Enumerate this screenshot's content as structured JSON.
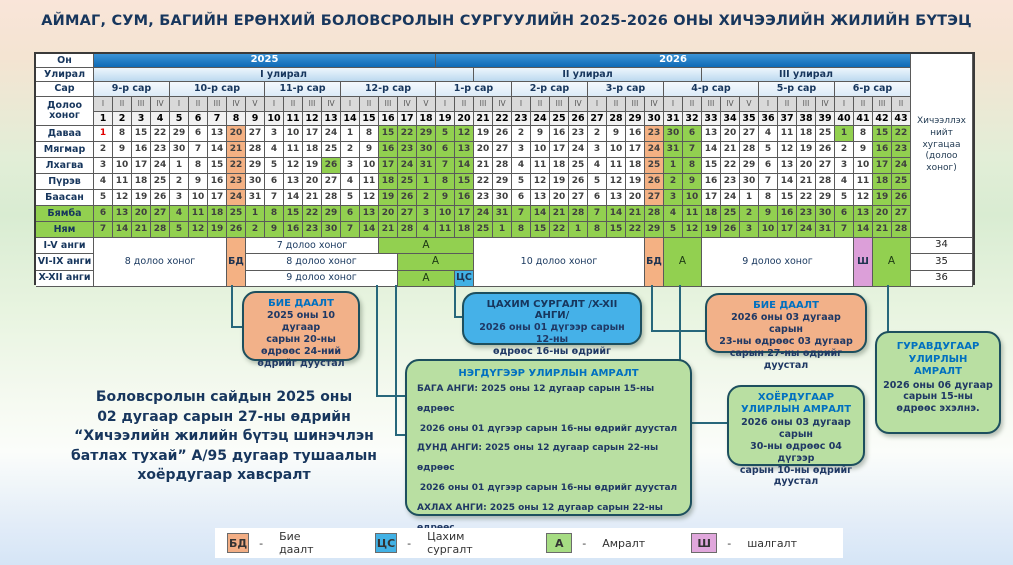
{
  "title": "АЙМАГ, СУМ, БАГИЙН ЕРӨНХИЙ БОЛОВСРОЛЫН СУРГУУЛИЙН 2025-2026 ОНЫ ХИЧЭЭЛИЙН ЖИЛИЙН БҮТЭЦ",
  "note_lines": [
    "Боловсролын сайдын 2025 оны",
    "02 дугаар сарын 27-ны өдрийн",
    "“Хичээлийн жилийн бүтэц шинэчлэн",
    "батлах тухай” А/95 дугаар тушаалын",
    "хоёрдугаар хавсралт"
  ],
  "table": {
    "corner_labels": {
      "year": "Он",
      "quarter": "Улирал",
      "month": "Сар",
      "week": "Долоо хоног"
    },
    "right_header": "Хичээллэх нийт хугацаа (долоо хоног)",
    "years": [
      {
        "label": "2025",
        "span": 18
      },
      {
        "label": "2026",
        "span": 25
      }
    ],
    "quarters": [
      {
        "label": "I улирал",
        "span": 20
      },
      {
        "label": "II улирал",
        "span": 12
      },
      {
        "label": "III улирал",
        "span": 11
      }
    ],
    "months": [
      {
        "label": "9-р сар",
        "span": 4
      },
      {
        "label": "10-р сар",
        "span": 5
      },
      {
        "label": "11-р сар",
        "span": 4
      },
      {
        "label": "12-р сар",
        "span": 5
      },
      {
        "label": "1-р сар",
        "span": 4
      },
      {
        "label": "2-р сар",
        "span": 4
      },
      {
        "label": "3-р сар",
        "span": 4
      },
      {
        "label": "4-р сар",
        "span": 5
      },
      {
        "label": "5-р сар",
        "span": 4
      },
      {
        "label": "6-р сар",
        "span": 4
      }
    ],
    "week_romans": [
      "I",
      "II",
      "III",
      "IV",
      "I",
      "II",
      "III",
      "IV",
      "V",
      "I",
      "II",
      "III",
      "IV",
      "I",
      "II",
      "III",
      "IV",
      "V",
      "I",
      "II",
      "III",
      "IV",
      "I",
      "II",
      "III",
      "IV",
      "I",
      "II",
      "III",
      "IV",
      "I",
      "II",
      "III",
      "IV",
      "V",
      "I",
      "II",
      "III",
      "IV",
      "I",
      "II",
      "III",
      "II"
    ],
    "week_numbers": [
      1,
      2,
      3,
      4,
      5,
      6,
      7,
      8,
      9,
      10,
      11,
      12,
      13,
      14,
      15,
      16,
      17,
      18,
      19,
      20,
      21,
      22,
      23,
      24,
      25,
      26,
      27,
      28,
      29,
      30,
      31,
      32,
      33,
      34,
      35,
      36,
      37,
      38,
      39,
      40,
      41,
      42,
      43
    ],
    "day_rows": [
      {
        "label": "Даваа",
        "weekend": false,
        "dates": [
          1,
          8,
          15,
          22,
          29,
          6,
          13,
          20,
          27,
          3,
          10,
          17,
          24,
          1,
          8,
          15,
          22,
          29,
          5,
          12,
          19,
          26,
          2,
          9,
          16,
          23,
          2,
          9,
          16,
          23,
          30,
          6,
          13,
          20,
          27,
          4,
          11,
          18,
          25,
          1,
          8,
          15,
          22
        ]
      },
      {
        "label": "Мягмар",
        "weekend": false,
        "dates": [
          2,
          9,
          16,
          23,
          30,
          7,
          14,
          21,
          28,
          4,
          11,
          18,
          25,
          2,
          9,
          16,
          23,
          30,
          6,
          13,
          20,
          27,
          3,
          10,
          17,
          24,
          3,
          10,
          17,
          24,
          31,
          7,
          14,
          21,
          28,
          5,
          12,
          19,
          26,
          2,
          9,
          16,
          23
        ]
      },
      {
        "label": "Лхагва",
        "weekend": false,
        "dates": [
          3,
          10,
          17,
          24,
          1,
          8,
          15,
          22,
          29,
          5,
          12,
          19,
          26,
          3,
          10,
          17,
          24,
          31,
          7,
          14,
          21,
          28,
          4,
          11,
          18,
          25,
          4,
          11,
          18,
          25,
          1,
          8,
          15,
          22,
          29,
          6,
          13,
          20,
          27,
          3,
          10,
          17,
          24
        ]
      },
      {
        "label": "Пүрэв",
        "weekend": false,
        "dates": [
          4,
          11,
          18,
          25,
          2,
          9,
          16,
          23,
          30,
          6,
          13,
          20,
          27,
          4,
          11,
          18,
          25,
          1,
          8,
          15,
          22,
          29,
          5,
          12,
          19,
          26,
          5,
          12,
          19,
          26,
          2,
          9,
          16,
          23,
          30,
          7,
          14,
          21,
          28,
          4,
          11,
          18,
          25
        ]
      },
      {
        "label": "Баасан",
        "weekend": false,
        "dates": [
          5,
          12,
          19,
          26,
          3,
          10,
          17,
          24,
          31,
          7,
          14,
          21,
          28,
          5,
          12,
          19,
          26,
          2,
          9,
          16,
          23,
          30,
          6,
          13,
          20,
          27,
          6,
          13,
          20,
          27,
          3,
          10,
          17,
          24,
          1,
          8,
          15,
          22,
          29,
          5,
          12,
          19,
          26
        ]
      },
      {
        "label": "Бямба",
        "weekend": true,
        "dates": [
          6,
          13,
          20,
          27,
          4,
          11,
          18,
          25,
          1,
          8,
          15,
          22,
          29,
          6,
          13,
          20,
          27,
          3,
          10,
          17,
          24,
          31,
          7,
          14,
          21,
          28,
          7,
          14,
          21,
          28,
          4,
          11,
          18,
          25,
          2,
          9,
          16,
          23,
          30,
          6,
          13,
          20,
          27
        ]
      },
      {
        "label": "Ням",
        "weekend": true,
        "dates": [
          7,
          14,
          21,
          28,
          5,
          12,
          19,
          26,
          2,
          9,
          16,
          23,
          30,
          7,
          14,
          21,
          28,
          4,
          11,
          18,
          25,
          1,
          8,
          15,
          22,
          1,
          8,
          15,
          22,
          29,
          5,
          12,
          19,
          26,
          3,
          10,
          17,
          24,
          31,
          7,
          14,
          21,
          28
        ]
      }
    ],
    "green_weeks": [
      16,
      17,
      18,
      19,
      20,
      31,
      32,
      42,
      43
    ],
    "orange_weeks": [
      8,
      30
    ],
    "extra_green_cells": [
      {
        "day": 2,
        "week": 13
      },
      {
        "day": 0,
        "week": 40
      }
    ],
    "red_cells": [
      {
        "day": 0,
        "week": 1
      }
    ],
    "class_rows": [
      {
        "label": "I-V анги",
        "total": "34"
      },
      {
        "label": "VI-IX анги",
        "total": "35"
      },
      {
        "label": "X-XII анги",
        "total": "36"
      }
    ],
    "band_segments": [
      {
        "label": "8 долоо хоног",
        "start": 1,
        "end": 7,
        "row": 0,
        "type": "plain"
      },
      {
        "label": "БД",
        "start": 8,
        "end": 8,
        "row": 0,
        "type": "bd"
      },
      {
        "label": "7 долоо хоног",
        "start": 9,
        "end": 15,
        "row": 1,
        "type": "plain"
      },
      {
        "label": "А",
        "start": 16,
        "end": 20,
        "row": 1,
        "type": "rest"
      },
      {
        "label": "8 долоо хоног",
        "start": 9,
        "end": 16,
        "row": 2,
        "type": "plain"
      },
      {
        "label": "А",
        "start": 17,
        "end": 20,
        "row": 2,
        "type": "rest"
      },
      {
        "label": "9 долоо хоног",
        "start": 9,
        "end": 16,
        "row": 3,
        "type": "plain"
      },
      {
        "label": "А",
        "start": 17,
        "end": 19,
        "row": 3,
        "type": "rest"
      },
      {
        "label": "ЦС",
        "start": 20,
        "end": 20,
        "row": 3,
        "type": "cs"
      },
      {
        "label": "10 долоо хоног",
        "start": 21,
        "end": 29,
        "row": 0,
        "type": "plain"
      },
      {
        "label": "БД",
        "start": 30,
        "end": 30,
        "row": 0,
        "type": "bd"
      },
      {
        "label": "А",
        "start": 31,
        "end": 32,
        "row": 0,
        "type": "rest"
      },
      {
        "label": "9 долоо хоног",
        "start": 33,
        "end": 40,
        "row": 0,
        "type": "plain"
      },
      {
        "label": "Ш",
        "start": 41,
        "end": 41,
        "row": 0,
        "type": "sh"
      },
      {
        "label": "А",
        "start": 42,
        "end": 43,
        "row": 0,
        "type": "rest"
      }
    ]
  },
  "callouts": {
    "bd1": {
      "title": "БИЕ ДААЛТ",
      "lines": [
        "2025 оны 10 дугаар",
        "сарын 20-ны",
        "өдрөөс 24-ний",
        "өдрийг дуустал"
      ]
    },
    "cs": {
      "title": "ЦАХИМ СУРГАЛТ /X-XII АНГИ/",
      "lines": [
        "2026 оны 01 дүгээр сарын 12-ны",
        "өдрөөс 16-ны өдрийг дуустал"
      ]
    },
    "bd2": {
      "title": "БИЕ ДААЛТ",
      "lines": [
        "2026 оны 03 дугаар сарын",
        "23-ны өдрөөс 03 дугаар",
        "сарын 27-ны өдрийг дуустал"
      ]
    },
    "q1": {
      "title": "НЭГДҮГЭЭР УЛИРЛЫН АМРАЛТ",
      "lines": [
        "БАГА АНГИ:  2025 оны 12 дугаар сарын 15-ны өдрөөс",
        "2026 оны 01 дүгээр сарын 16-ны өдрийг дуустал",
        "ДУНД АНГИ:  2025 оны 12 дугаар сарын 22-ны өдрөөс",
        "2026 оны 01 дүгээр сарын 16-ны өдрийг дуустал",
        "АХЛАХ АНГИ: 2025 оны 12 дугаар сарын 22-ны өдрөөс",
        "2026 оны 01 дүгээр сарын 09-ний өдрийг дуустал"
      ]
    },
    "q2": {
      "title": "ХОЁРДУГААР УЛИРЛЫН АМРАЛТ",
      "lines": [
        "2026 оны 03 дугаар сарын",
        "30-ны өдрөөс 04 дүгээр",
        "сарын 10-ны өдрийг",
        "дуустал"
      ]
    },
    "q3": {
      "title": "ГУРАВДУГААР УЛИРЛЫН АМРАЛТ",
      "lines": [
        "2026 оны 06 дугаар",
        "сарын 15-ны",
        "өдрөөс эхэлнэ."
      ]
    }
  },
  "legend": [
    {
      "code": "БД",
      "label": "Бие даалт",
      "color": "#f2ae85"
    },
    {
      "code": "ЦС",
      "label": "Цахим сургалт",
      "color": "#41b1e5"
    },
    {
      "code": "А",
      "label": "Амралт",
      "color": "#a6dc83"
    },
    {
      "code": "Ш",
      "label": "шалгалт",
      "color": "#e0a7dc"
    }
  ],
  "colors": {
    "year_band": "#1878c2",
    "quarter_band": "#cfe4f5",
    "month_band": "#e8f1fa",
    "rest_green": "#92d050",
    "bd_orange": "#f4b183",
    "cs_blue": "#41b1e5",
    "exam_pink": "#dc9fd9",
    "box_green": "#b9dfa2",
    "box_orange": "#f2b189",
    "box_blue": "#45b1e8",
    "accent_blue": "#0070c0",
    "navy": "#17365d",
    "connector": "#27677b"
  }
}
